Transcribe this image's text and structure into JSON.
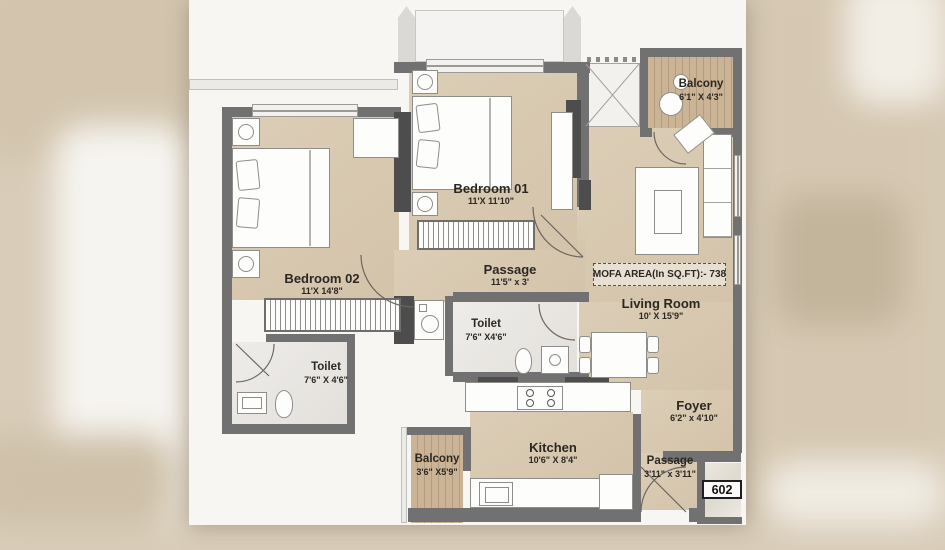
{
  "plan": {
    "unit_number": "602",
    "mofa_area_label": "MOFA AREA(In SQ.FT):- 738",
    "rooms": {
      "bedroom01": {
        "name": "Bedroom 01",
        "dims": "11'X 11'10\""
      },
      "bedroom02": {
        "name": "Bedroom 02",
        "dims": "11'X 14'8\""
      },
      "passage_mid": {
        "name": "Passage",
        "dims": "11'5\" x 3'"
      },
      "toilet_left": {
        "name": "Toilet",
        "dims": "7'6\" X 4'6\""
      },
      "toilet_mid": {
        "name": "Toilet",
        "dims": "7'6\" X4'6\""
      },
      "living_room": {
        "name": "Living Room",
        "dims": "10' X 15'9\""
      },
      "balcony_top": {
        "name": "Balcony",
        "dims": "6'1\" X 4'3\""
      },
      "balcony_bottom": {
        "name": "Balcony",
        "dims": "3'6\" X5'9\""
      },
      "kitchen": {
        "name": "Kitchen",
        "dims": "10'6\" X 8'4\""
      },
      "foyer": {
        "name": "Foyer",
        "dims": "6'2\" x 4'10\""
      },
      "passage_entry": {
        "name": "Passage",
        "dims": "3'11\" x 3'11\""
      }
    },
    "colors": {
      "floor_tan": "#d8c9b1",
      "wall_gray": "#717171",
      "wood": "#c8b193",
      "paper": "#f7f6f3"
    }
  }
}
